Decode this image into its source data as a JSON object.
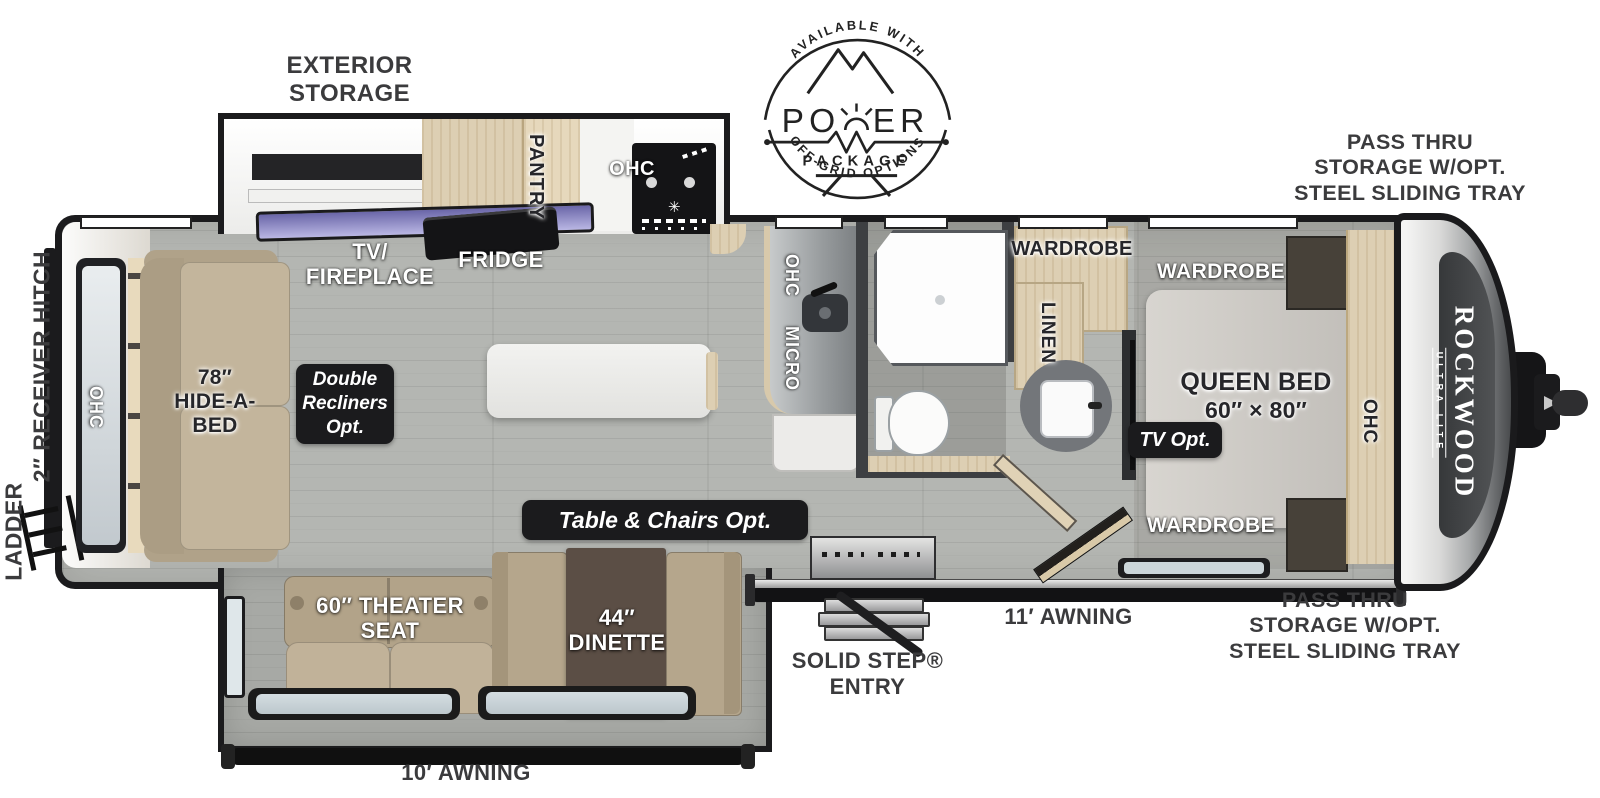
{
  "badge_logo": {
    "top": "AVAILABLE WITH",
    "word": "POWER",
    "sub": "PACKAGE",
    "bottom": "OFF-GRID OPTIONS"
  },
  "brand": {
    "name": "ROCKWOOD",
    "tier": "ULTRA LITE"
  },
  "callouts": {
    "exterior_storage": {
      "l1": "EXTERIOR",
      "l2": "STORAGE"
    },
    "pass_thru_top": {
      "l1": "PASS THRU",
      "l2": "STORAGE W/OPT.",
      "l3": "STEEL SLIDING TRAY"
    },
    "pass_thru_bottom": {
      "l1": "PASS THRU",
      "l2": "STORAGE W/OPT.",
      "l3": "STEEL SLIDING TRAY"
    },
    "receiver_hitch": "2″ RECEIVER HITCH",
    "ladder": "LADDER",
    "solid_step": {
      "l1": "SOLID STEP®",
      "l2": "ENTRY"
    },
    "awning_11": "11′ AWNING",
    "awning_10": "10′ AWNING"
  },
  "rooms": {
    "tv_fireplace": {
      "l1": "TV/",
      "l2": "FIREPLACE"
    },
    "fridge": "FRIDGE",
    "pantry": "PANTRY",
    "ohc_stove": "OHC",
    "ohc_counter": "OHC",
    "micro": "MICRO",
    "ohc_rear": "OHC",
    "hide_a_bed": {
      "l1": "78″",
      "l2": "HIDE-A-",
      "l3": "BED"
    },
    "double_recliners": {
      "l1": "Double",
      "l2": "Recliners",
      "l3": "Opt."
    },
    "table_chairs": "Table & Chairs Opt.",
    "theater_seat": {
      "l1": "60″ THEATER",
      "l2": "SEAT"
    },
    "dinette": {
      "l1": "44″",
      "l2": "DINETTE"
    },
    "wardrobe_bath": "WARDROBE",
    "linen": "LINEN",
    "wardrobe_bed_top": "WARDROBE",
    "wardrobe_bed_bottom": "WARDROBE",
    "queen_bed": {
      "l1": "QUEEN BED",
      "l2": "60″ × 80″"
    },
    "tv_opt": "TV Opt.",
    "ohc_bed": "OHC"
  },
  "colors": {
    "outline": "#1b1b1d",
    "label_dark": "#3b3b3d",
    "floor": "#b4b6b2",
    "wood": "#ddcfb3"
  }
}
